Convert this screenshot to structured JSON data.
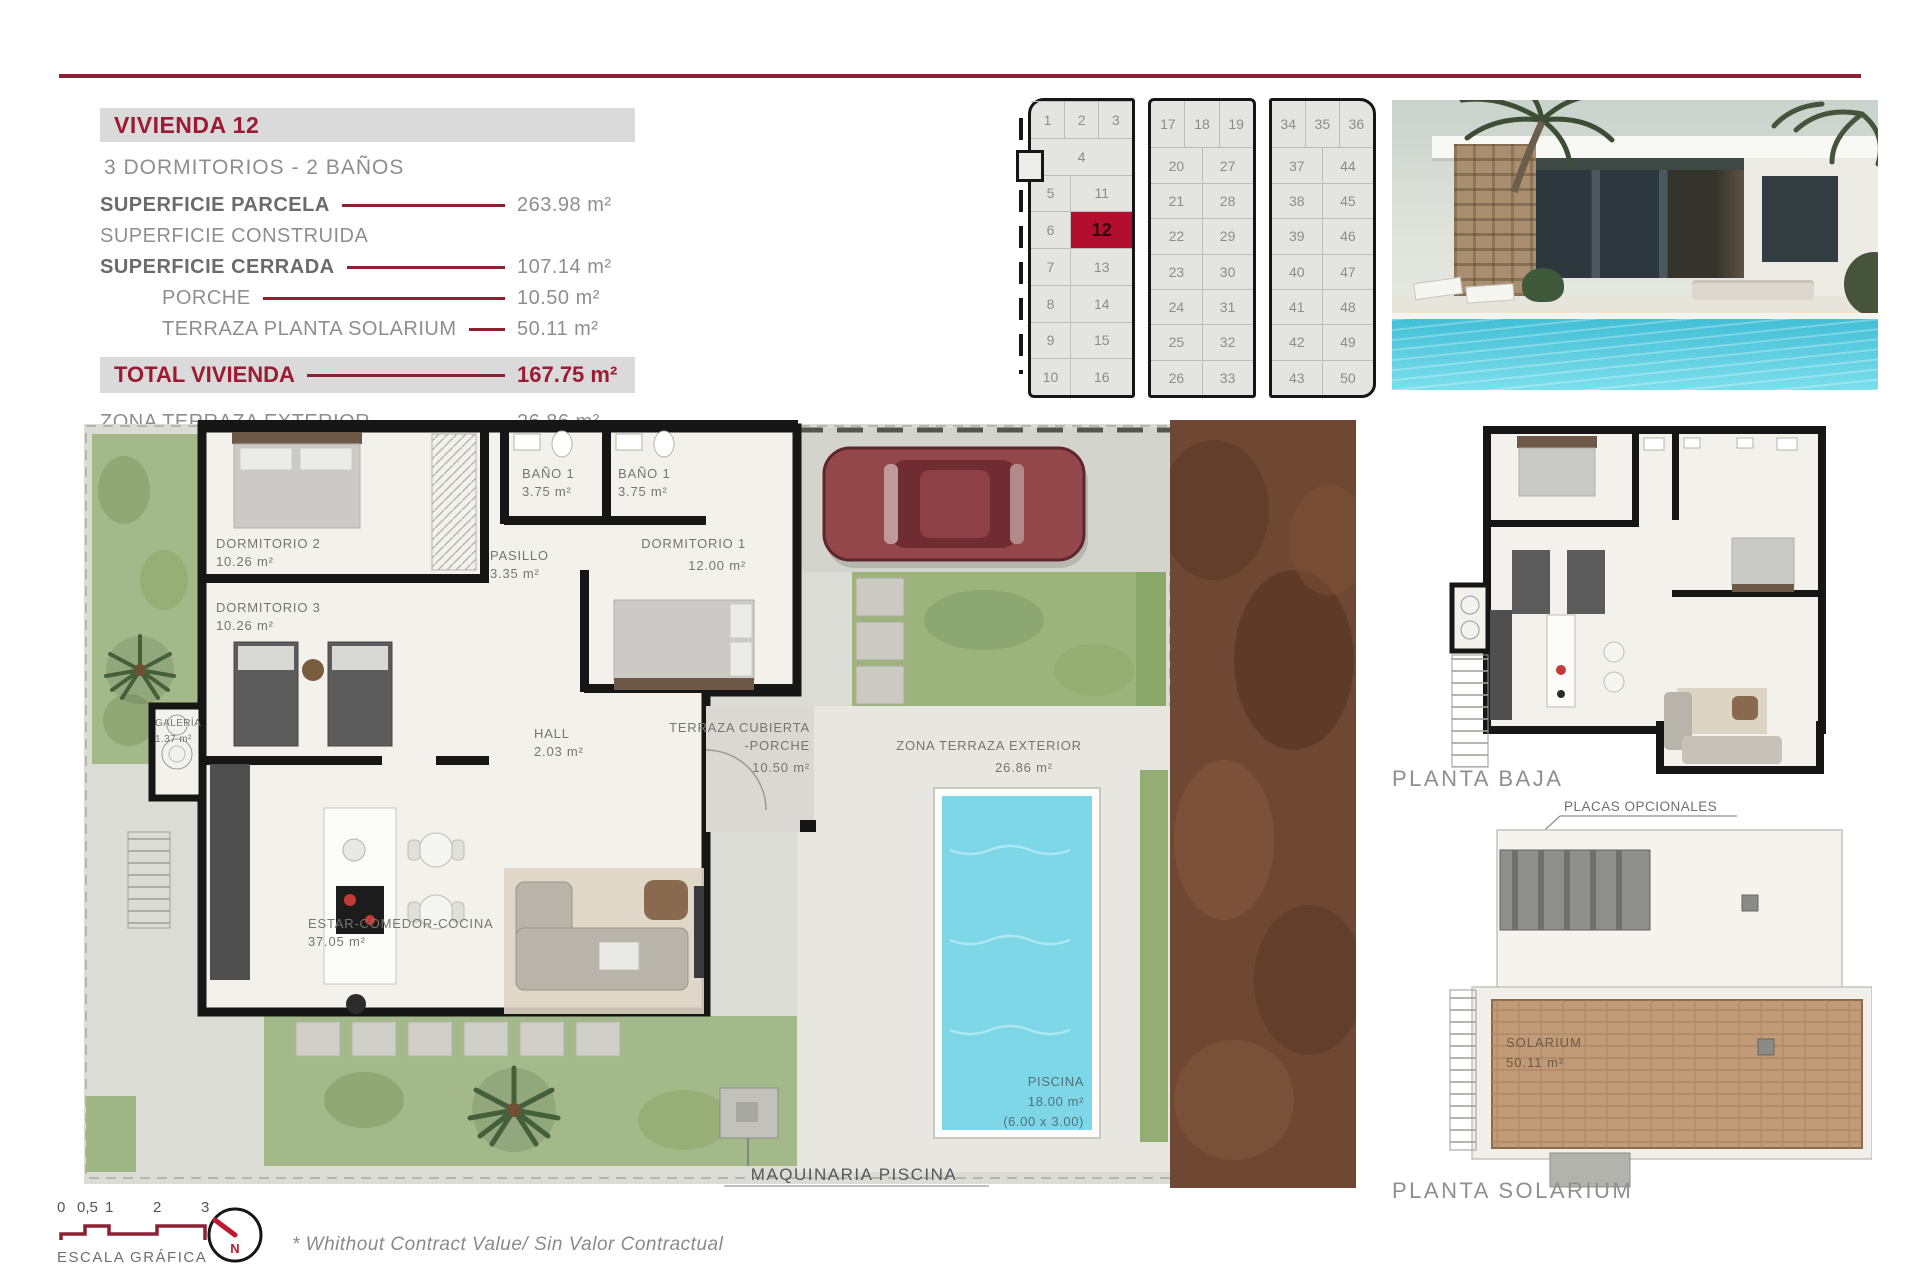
{
  "colors": {
    "accent": "#9c1b33",
    "highlight_red": "#b30e2e",
    "band_gray": "#dadada",
    "pool_blue": "#7ed7e7"
  },
  "info_panel": {
    "title": "VIVIENDA 12",
    "subtitle": "3 DORMITORIOS - 2 BAÑOS",
    "rows": [
      {
        "label": "SUPERFICIE PARCELA",
        "value": "263.98 m²"
      },
      {
        "label": "SUPERFICIE CONSTRUIDA",
        "value": ""
      },
      {
        "label": "SUPERFICIE CERRADA",
        "value": "107.14 m²"
      },
      {
        "label": "PORCHE",
        "value": "10.50 m²"
      },
      {
        "label": "TERRAZA PLANTA SOLARIUM",
        "value": "50.11 m²"
      }
    ],
    "total": {
      "label": "TOTAL VIVIENDA",
      "value": "167.75 m²"
    },
    "extra": {
      "label": "ZONA TERRAZA EXTERIOR",
      "value": "26.86 m²"
    }
  },
  "site_plan": {
    "highlighted_plot": "12",
    "blocks": [
      {
        "top": [
          "1",
          "2",
          "3"
        ],
        "rows": [
          [
            "",
            "4"
          ],
          [
            "5",
            "11"
          ],
          [
            "6",
            "12"
          ],
          [
            "7",
            "13"
          ],
          [
            "8",
            "14"
          ],
          [
            "9",
            "15"
          ],
          [
            "10",
            "16"
          ]
        ]
      },
      {
        "top": [
          "17",
          "18",
          "19"
        ],
        "rows": [
          [
            "20",
            "27"
          ],
          [
            "21",
            "28"
          ],
          [
            "22",
            "29"
          ],
          [
            "23",
            "30"
          ],
          [
            "24",
            "31"
          ],
          [
            "25",
            "32"
          ],
          [
            "26",
            "33"
          ]
        ]
      },
      {
        "top": [
          "34",
          "35",
          "36"
        ],
        "rows": [
          [
            "37",
            "44"
          ],
          [
            "38",
            "45"
          ],
          [
            "39",
            "46"
          ],
          [
            "40",
            "47"
          ],
          [
            "41",
            "48"
          ],
          [
            "42",
            "49"
          ],
          [
            "43",
            "50"
          ]
        ]
      }
    ]
  },
  "floor_plan": {
    "rooms": [
      {
        "name": "DORMITORIO 2",
        "area": "10.26 m²"
      },
      {
        "name": "DORMITORIO 3",
        "area": "10.26 m²"
      },
      {
        "name": "BAÑO 1",
        "area": "3.75 m²"
      },
      {
        "name": "BAÑO 1",
        "area": "3.75 m²"
      },
      {
        "name": "PASILLO",
        "area": "3.35 m²"
      },
      {
        "name": "DORMITORIO 1",
        "area": "12.00 m²"
      },
      {
        "name": "GALERÍA",
        "area": "1.37 m²"
      },
      {
        "name": "HALL",
        "area": "2.03 m²"
      },
      {
        "name": "TERRAZA CUBIERTA",
        "name2": "-PORCHE",
        "area": "10.50 m²"
      },
      {
        "name": "ZONA TERRAZA EXTERIOR",
        "area": "26.86 m²"
      },
      {
        "name": "ESTAR-COMEDOR-COCINA",
        "area": "37.05 m²"
      },
      {
        "name": "PISCINA",
        "area": "18.00 m²",
        "dims": "(6.00 x 3.00)"
      }
    ],
    "machinery_label": "MAQUINARIA PISCINA"
  },
  "side_plans": {
    "planta_baja_label": "PLANTA BAJA",
    "placas_label": "PLACAS OPCIONALES",
    "solarium_room": {
      "name": "SOLARIUM",
      "area": "50.11 m²"
    },
    "planta_solarium_label": "PLANTA SOLARIUM"
  },
  "footer": {
    "scale_ticks": [
      "0",
      "0,5",
      "1",
      "2",
      "3"
    ],
    "scale_label": "ESCALA GRÁFICA",
    "compass_label": "N",
    "disclaimer": "* Whithout Contract Value/ Sin Valor Contractual"
  }
}
